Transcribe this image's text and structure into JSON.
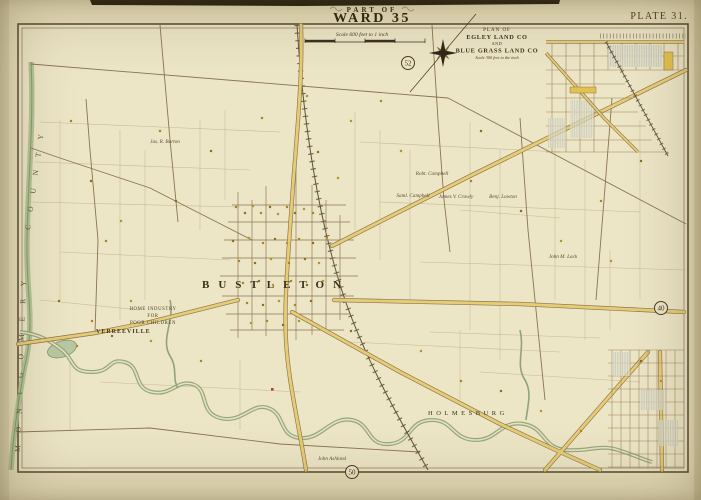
{
  "page": {
    "series_title": "PART OF",
    "ward_title": "WARD 35",
    "plate_label": "PLATE 31.",
    "scale_note": "Scale 600 feet to 1 inch"
  },
  "inset": {
    "line1": "PLAN OF",
    "line2": "EGLEY LAND CO",
    "line3": "AND",
    "line4": "BLUE GRASS LAND CO",
    "scale_note": "Scale 300 feet to the inch"
  },
  "map": {
    "county_words": [
      {
        "t": "MONTGOMERY",
        "x": 20,
        "y": 452,
        "rot": -88
      },
      {
        "t": "COUNTY",
        "x": 30,
        "y": 230,
        "rot": -82
      }
    ],
    "plate_refs": [
      {
        "n": "52",
        "x": 408,
        "y": 63
      },
      {
        "n": "40",
        "x": 661,
        "y": 308
      },
      {
        "n": "50",
        "x": 352,
        "y": 472
      }
    ],
    "labels": [
      {
        "t": "BUSTLETON",
        "x": 202,
        "y": 288,
        "cls": "village"
      },
      {
        "t": "VERREEVILLE",
        "x": 96,
        "y": 333,
        "cls": "hamlet"
      },
      {
        "t": "HOLMESBURG",
        "x": 428,
        "y": 415,
        "cls": "village2"
      },
      {
        "t": "HOME INDUSTRY",
        "x": 153,
        "y": 310,
        "cls": "tinycaps"
      },
      {
        "t": "FOR",
        "x": 153,
        "y": 317,
        "cls": "tinycaps"
      },
      {
        "t": "POOR CHILDREN",
        "x": 153,
        "y": 324,
        "cls": "tinycaps"
      },
      {
        "t": "Jas. R. Barton",
        "x": 165,
        "y": 143,
        "cls": "owner"
      },
      {
        "t": "Robt. Campbell",
        "x": 432,
        "y": 175,
        "cls": "owner"
      },
      {
        "t": "Saml. Campbell",
        "x": 413,
        "y": 197,
        "cls": "owner"
      },
      {
        "t": "James V. Crawly",
        "x": 456,
        "y": 198,
        "cls": "owner"
      },
      {
        "t": "Benj. Lawton",
        "x": 503,
        "y": 198,
        "cls": "owner"
      },
      {
        "t": "John M. Lack",
        "x": 563,
        "y": 258,
        "cls": "owner"
      },
      {
        "t": "John Ashland",
        "x": 332,
        "y": 460,
        "cls": "owner"
      }
    ]
  }
}
